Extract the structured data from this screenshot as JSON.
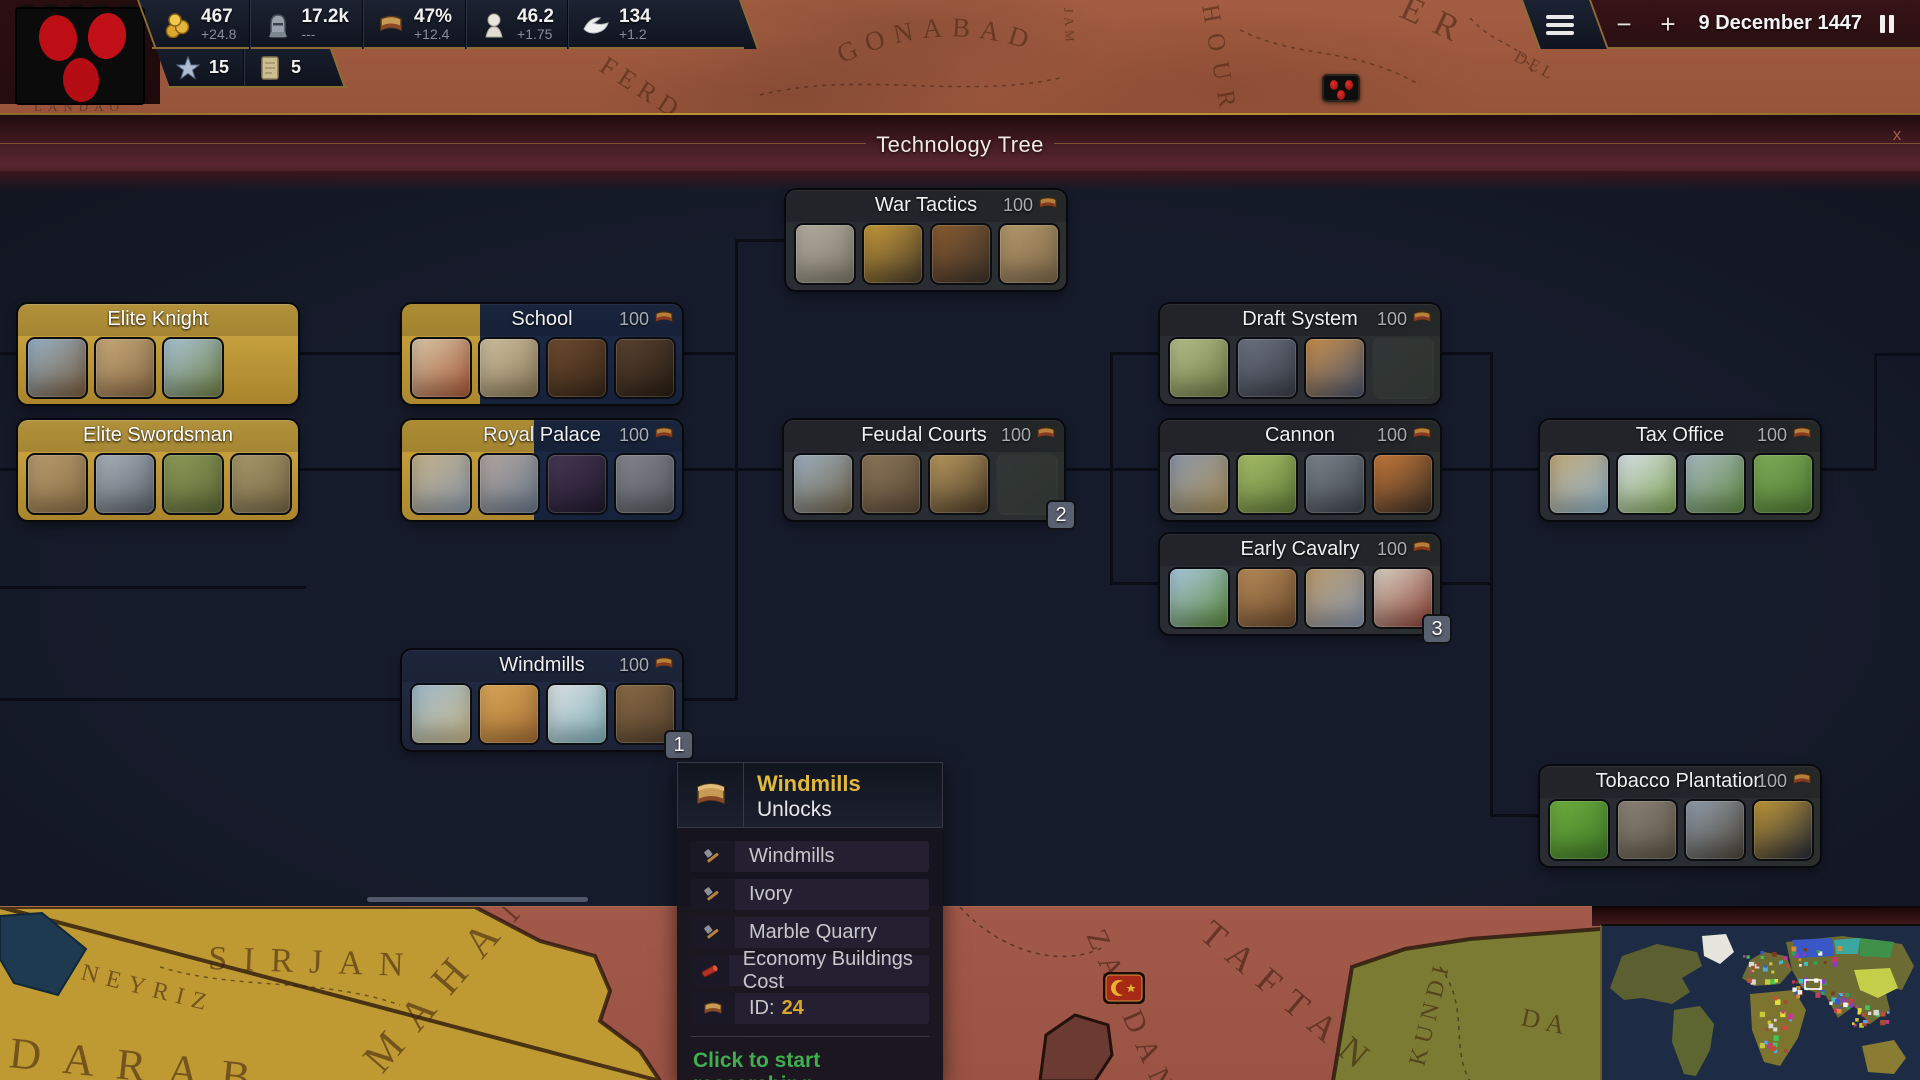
{
  "top_bar": {
    "resources": [
      {
        "id": "gold",
        "icon": "coins-icon",
        "value": "467",
        "delta": "+24.8"
      },
      {
        "id": "manpower",
        "icon": "soldier-icon",
        "value": "17.2k",
        "delta": "---"
      },
      {
        "id": "research",
        "icon": "scroll-icon",
        "value": "47%",
        "delta": "+12.4"
      },
      {
        "id": "prestige",
        "icon": "bust-icon",
        "value": "46.2",
        "delta": "+1.75"
      },
      {
        "id": "doves",
        "icon": "dove-icon",
        "value": "134",
        "delta": "+1.2"
      }
    ],
    "secondary": [
      {
        "id": "stars",
        "icon": "star-icon",
        "value": "15"
      },
      {
        "id": "documents",
        "icon": "paper-icon",
        "value": "5"
      }
    ],
    "date": "9 December 1447",
    "zoom_out": "−",
    "zoom_in": "+"
  },
  "overlay": {
    "title": "Technology Tree",
    "close": "x"
  },
  "tech_tree": {
    "nodes": [
      {
        "id": "elite-knight",
        "title": "Elite Knight",
        "state": "researched",
        "pos": {
          "x": 18,
          "y": 304
        },
        "thumbs": [
          {
            "name": "thumb-castle-town",
            "c1": "#97b4c9",
            "c2": "#7a5c3d"
          },
          {
            "name": "thumb-knight-white-horse",
            "c1": "#c7aa7a",
            "c2": "#8a6a45"
          },
          {
            "name": "thumb-knight-charge",
            "c1": "#a9c5d6",
            "c2": "#6f7f45"
          }
        ]
      },
      {
        "id": "elite-swordsman",
        "title": "Elite Swordsman",
        "state": "researched",
        "pos": {
          "x": 18,
          "y": 420
        },
        "thumbs": [
          {
            "name": "thumb-fortress-wall",
            "c1": "#b79c6d",
            "c2": "#8a6f46"
          },
          {
            "name": "thumb-armored-knight",
            "c1": "#a9b2bb",
            "c2": "#5c636c"
          },
          {
            "name": "thumb-shield-soldiers",
            "c1": "#8f9c57",
            "c2": "#5d6838"
          },
          {
            "name": "thumb-marching-army",
            "c1": "#a89a6b",
            "c2": "#756745"
          }
        ]
      },
      {
        "id": "school",
        "title": "School",
        "state": "in-progress",
        "progress": 28,
        "cost": "100",
        "pos": {
          "x": 402,
          "y": 304
        },
        "thumbs": [
          {
            "name": "thumb-school-courtyard",
            "c1": "#d8c8a8",
            "c2": "#a85838"
          },
          {
            "name": "thumb-ruined-hall",
            "c1": "#cfc0a0",
            "c2": "#8a7a58"
          },
          {
            "name": "thumb-book-stack",
            "c1": "#6e4c30",
            "c2": "#392718"
          },
          {
            "name": "thumb-scholars-table",
            "c1": "#5a4430",
            "c2": "#281d14"
          }
        ]
      },
      {
        "id": "royal-palace",
        "title": "Royal Palace",
        "state": "in-progress",
        "progress": 47,
        "cost": "100",
        "pos": {
          "x": 402,
          "y": 420
        },
        "thumbs": [
          {
            "name": "thumb-palace",
            "c1": "#c3b089",
            "c2": "#8c9aab"
          },
          {
            "name": "thumb-mansion",
            "c1": "#b5a8a2",
            "c2": "#68788a"
          },
          {
            "name": "thumb-night-hall",
            "c1": "#473853",
            "c2": "#201a2e"
          },
          {
            "name": "thumb-sword",
            "c1": "#83878d",
            "c2": "#55585e"
          }
        ]
      },
      {
        "id": "war-tactics",
        "title": "War Tactics",
        "state": "locked",
        "cost": "100",
        "pos": {
          "x": 786,
          "y": 190
        },
        "thumbs": [
          {
            "name": "thumb-command-building",
            "c1": "#b3aea0",
            "c2": "#7d786a"
          },
          {
            "name": "thumb-trumpet",
            "c1": "#c79a3a",
            "c2": "#4a3d2b"
          },
          {
            "name": "thumb-whip",
            "c1": "#8a5c31",
            "c2": "#3b332a"
          },
          {
            "name": "thumb-siege-works",
            "c1": "#b59a6c",
            "c2": "#7d674a"
          }
        ]
      },
      {
        "id": "feudal-courts",
        "title": "Feudal Courts",
        "state": "locked",
        "cost": "100",
        "number": "2",
        "pos": {
          "x": 784,
          "y": 420
        },
        "thumbs": [
          {
            "name": "thumb-court-castle",
            "c1": "#9fb0c0",
            "c2": "#6e6349"
          },
          {
            "name": "thumb-manor-courtyard",
            "c1": "#8c7659",
            "c2": "#5a4936"
          },
          {
            "name": "thumb-gold-tribute",
            "c1": "#b8995f",
            "c2": "#4c3c29"
          }
        ]
      },
      {
        "id": "draft-system",
        "title": "Draft System",
        "state": "locked",
        "cost": "100",
        "pos": {
          "x": 1160,
          "y": 304
        },
        "thumbs": [
          {
            "name": "thumb-musketeer-line",
            "c1": "#b5c08b",
            "c2": "#6f7a45"
          },
          {
            "name": "thumb-dark-courtyard",
            "c1": "#6d7381",
            "c2": "#393d47"
          },
          {
            "name": "thumb-battlefield-dawn",
            "c1": "#c98f4d",
            "c2": "#49556b"
          }
        ]
      },
      {
        "id": "cannon",
        "title": "Cannon",
        "state": "locked",
        "cost": "100",
        "pos": {
          "x": 1160,
          "y": 420
        },
        "thumbs": [
          {
            "name": "thumb-harbor-town",
            "c1": "#8b97a9",
            "c2": "#a98f58"
          },
          {
            "name": "thumb-farm-fields",
            "c1": "#a8c06a",
            "c2": "#5f7a38"
          },
          {
            "name": "thumb-field-cannon",
            "c1": "#7d848d",
            "c2": "#3e444c"
          },
          {
            "name": "thumb-burning-fortress",
            "c1": "#c87a3a",
            "c2": "#3a2f26"
          }
        ]
      },
      {
        "id": "early-cavalry",
        "title": "Early Cavalry",
        "state": "locked",
        "cost": "100",
        "number": "3",
        "pos": {
          "x": 1160,
          "y": 534
        },
        "thumbs": [
          {
            "name": "thumb-vineyard-hills",
            "c1": "#a9c9e0",
            "c2": "#5d8a3d"
          },
          {
            "name": "thumb-timber-inn",
            "c1": "#b78c58",
            "c2": "#6d4b2f"
          },
          {
            "name": "thumb-cavalry-charge",
            "c1": "#b99a6b",
            "c2": "#8a98b0"
          },
          {
            "name": "thumb-white-horse-knight",
            "c1": "#d9d2c5",
            "c2": "#8a3f31"
          }
        ]
      },
      {
        "id": "tax-office",
        "title": "Tax Office",
        "state": "locked",
        "cost": "100",
        "pos": {
          "x": 1540,
          "y": 420
        },
        "thumbs": [
          {
            "name": "thumb-office-building",
            "c1": "#c2a87a",
            "c2": "#8db2ca"
          },
          {
            "name": "thumb-green-valley",
            "c1": "#d9e1e8",
            "c2": "#7fa554"
          },
          {
            "name": "thumb-tea-hills",
            "c1": "#a9bac2",
            "c2": "#5f8a42"
          },
          {
            "name": "thumb-hedge-fields",
            "c1": "#7fae57",
            "c2": "#4f7a35"
          }
        ]
      },
      {
        "id": "windmills",
        "title": "Windmills",
        "state": "locked",
        "highlight": true,
        "cost": "100",
        "number": "1",
        "pos": {
          "x": 402,
          "y": 650
        },
        "thumbs": [
          {
            "name": "thumb-windmill-plain",
            "c1": "#9db8cc",
            "c2": "#c9b988"
          },
          {
            "name": "thumb-ivory-elephant",
            "c1": "#d9a858",
            "c2": "#a86f35"
          },
          {
            "name": "thumb-marble-quarry",
            "c1": "#dde1e4",
            "c2": "#7fb0b8"
          },
          {
            "name": "thumb-old-town",
            "c1": "#8a6b46",
            "c2": "#54402c"
          }
        ]
      },
      {
        "id": "tobacco-plantation",
        "title": "Tobacco Plantation",
        "state": "locked",
        "cost": "100",
        "pos": {
          "x": 1540,
          "y": 766
        },
        "thumbs": [
          {
            "name": "thumb-tobacco-field",
            "c1": "#6fae3f",
            "c2": "#3f7a28"
          },
          {
            "name": "thumb-castle-gathering",
            "c1": "#8c8478",
            "c2": "#5b5345"
          },
          {
            "name": "thumb-dusk-plantation",
            "c1": "#93a0ae",
            "c2": "#4c4336"
          },
          {
            "name": "thumb-golden-eagle",
            "c1": "#c49a38",
            "c2": "#232a38"
          }
        ]
      }
    ]
  },
  "tooltip": {
    "title": "Windmills",
    "subtitle": "Unlocks",
    "rows": [
      {
        "icon": "hammer-icon",
        "label": "Windmills"
      },
      {
        "icon": "hammer-icon",
        "label": "Ivory"
      },
      {
        "icon": "hammer-icon",
        "label": "Marble Quarry"
      },
      {
        "icon": "modifier-icon",
        "label": "Economy Buildings Cost"
      },
      {
        "icon": "scroll-icon",
        "label": "ID:",
        "value": "24"
      }
    ],
    "action": "Click to start researching",
    "title_color": "#e2b93e",
    "action_color": "#3fae4f"
  },
  "map": {
    "labels": {
      "gonabad": "GONABAD",
      "ferd": "FERD",
      "jam": "JAM",
      "hour": "HOUR",
      "er": "ER",
      "del": "DEL",
      "landao": "LANDAO",
      "neyriz": "NEYRIZ",
      "sirjan": "SIRJAN",
      "darab": "DARAB",
      "mahan": "MAHAN",
      "zaedan": "ZAEDAN",
      "taftan": "TAFTAN",
      "kundi": "KUNDI",
      "da": "DA"
    },
    "colors": {
      "yellow_country": "#bf9a33",
      "red_country": "#a2594a",
      "green_country": "#7b7b33",
      "lake": "#1d3a50"
    }
  },
  "minimap": {
    "ocean": "#1d2b45",
    "land": "#6b6b33",
    "viewport_stroke": "#ffffff"
  },
  "colors": {
    "gold_accent": "#c9a53f",
    "panel_gold_trim": "#8a6d35",
    "progress_fill": "#cda73e",
    "action_green": "#3fae4f"
  }
}
